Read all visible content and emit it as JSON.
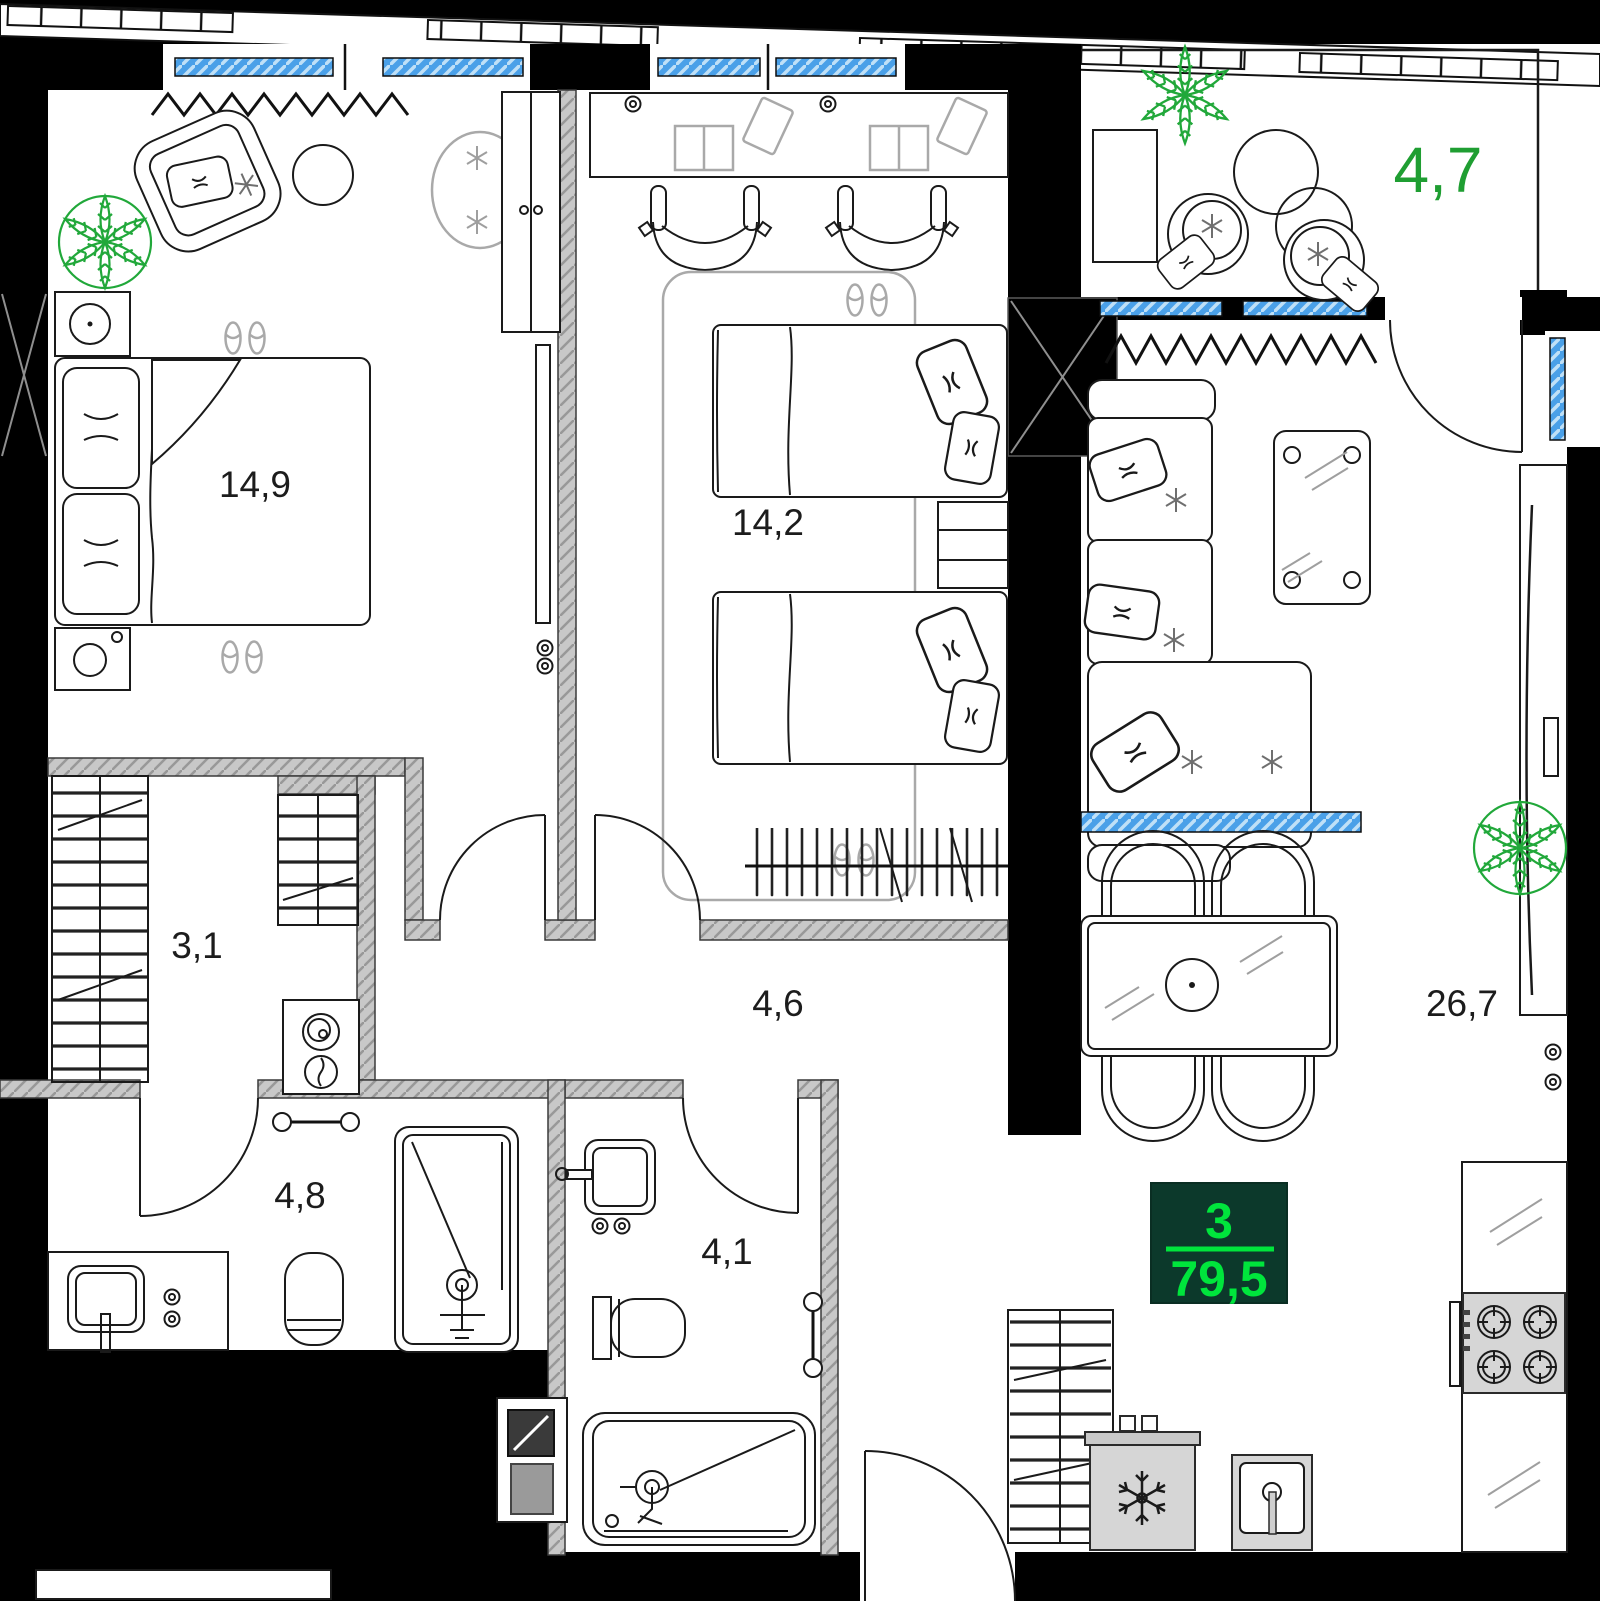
{
  "unit": {
    "rooms_count": "3",
    "area_total_m2": "79,5"
  },
  "rooms": {
    "bedroom_1": {
      "area_label": "14,9"
    },
    "bedroom_2": {
      "area_label": "14,2"
    },
    "balcony": {
      "area_label": "4,7"
    },
    "living_kitchen": {
      "area_label": "26,7"
    },
    "wardrobe": {
      "area_label": "3,1"
    },
    "hallway": {
      "area_label": "4,6"
    },
    "bathroom": {
      "area_label": "4,8"
    },
    "wc": {
      "area_label": "4,1"
    }
  },
  "colors": {
    "exterior_wall": "#000000",
    "partition_wall_gray": "#c8c8c8",
    "window_glass_blue": "#4aa0e8",
    "balcony_label_green": "#1f9e32",
    "badge_background": "#0c392b",
    "badge_text_green": "#00e53c",
    "plant_green": "#21a83a"
  },
  "icons": [
    "double-bed-icon",
    "single-bed-icon",
    "armchair-icon",
    "sofa-icon",
    "coffee-table-icon",
    "dining-table-icon",
    "dining-chair-icon",
    "desk-icon",
    "desk-chair-icon",
    "open-book-icon",
    "tablet-icon",
    "wardrobe-hangers-icon",
    "coat-rack-icon",
    "washing-machine-icon",
    "toilet-icon",
    "shower-icon",
    "bathtub-icon",
    "sink-icon",
    "vanity-icon",
    "fridge-snowflake-icon",
    "stove-burners-icon",
    "kitchen-sink-icon",
    "tv-icon",
    "radiator-icon",
    "window-glass-icon",
    "door-swing-icon",
    "plant-icon",
    "slippers-icon",
    "pillow-icon",
    "socket-icon",
    "shaft-x-icon",
    "railing-icon"
  ]
}
